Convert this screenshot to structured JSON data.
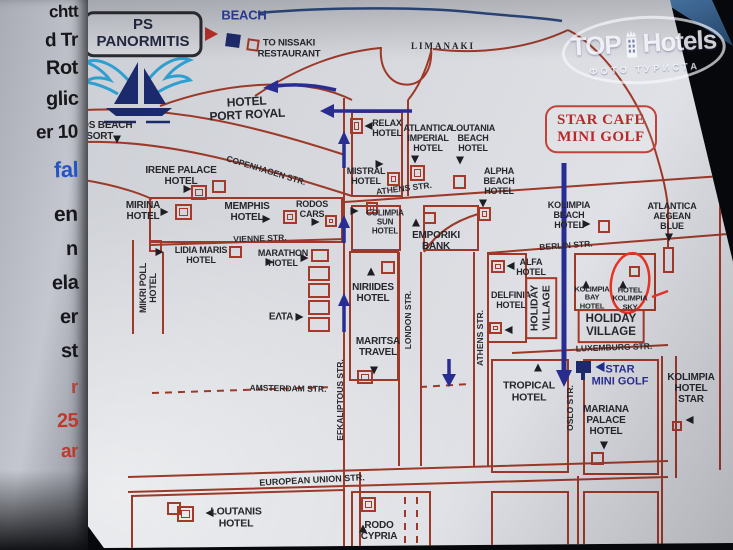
{
  "watermark": {
    "t1": "TOP",
    "t2": "Hotels",
    "sub": "ФОТО ТУРИСТА"
  },
  "neighbor_page": {
    "fragments": [
      {
        "t": "chtt",
        "y": 2,
        "c": "#17171b",
        "s": 17
      },
      {
        "t": "d Tr",
        "y": 30,
        "c": "#17171b",
        "s": 19
      },
      {
        "t": "Rot",
        "y": 57,
        "c": "#17171b",
        "s": 20
      },
      {
        "t": "glic",
        "y": 88,
        "c": "#17171b",
        "s": 20
      },
      {
        "t": "er 10",
        "y": 122,
        "c": "#17171b",
        "s": 19
      },
      {
        "t": "fal",
        "y": 157,
        "c": "#2356c4",
        "s": 22
      },
      {
        "t": "en",
        "y": 203,
        "c": "#17171b",
        "s": 21
      },
      {
        "t": "n",
        "y": 238,
        "c": "#17171b",
        "s": 20
      },
      {
        "t": "ela",
        "y": 272,
        "c": "#17171b",
        "s": 20
      },
      {
        "t": "er",
        "y": 306,
        "c": "#17171b",
        "s": 20
      },
      {
        "t": "st",
        "y": 340,
        "c": "#17171b",
        "s": 20
      },
      {
        "t": "r",
        "y": 377,
        "c": "#b4443c",
        "s": 19
      },
      {
        "t": "25",
        "y": 410,
        "c": "#c0392d",
        "s": 20
      },
      {
        "t": "ar",
        "y": 441,
        "c": "#c0392d",
        "s": 19
      }
    ]
  },
  "map": {
    "labels": [
      {
        "id": "sign-ps-panormitis",
        "t": "PS\nPANORMITIS",
        "x": 143,
        "y": 34,
        "cls": "sign-ps",
        "fs": 15
      },
      {
        "id": "label-beach",
        "t": "BEACH",
        "x": 244,
        "y": 16,
        "cls": "blue",
        "fs": 13
      },
      {
        "id": "label-to-nissaki",
        "t": "TO NISSAKI\nRESTAURANT",
        "x": 289,
        "y": 49,
        "fs": 9.5
      },
      {
        "id": "label-limanaki",
        "t": "LIMANAKI",
        "x": 443,
        "y": 46,
        "cls": "serif",
        "fs": 9
      },
      {
        "id": "sign-star-cafe",
        "t": "STAR CAFE\nMINI GOLF",
        "x": 601,
        "y": 129,
        "cls": "sign-cafe",
        "fs": 15
      },
      {
        "id": "hotel-port-royal",
        "t": "HOTEL\nPORT ROYAL",
        "x": 247,
        "y": 109,
        "r": -3,
        "fs": 12
      },
      {
        "id": "hotel-mythos-beach",
        "t": "MYTHOS BEACH\nRESORT",
        "x": 93,
        "y": 131,
        "fs": 10
      },
      {
        "id": "hotel-irene-palace",
        "t": "IRENE PALACE\nHOTEL",
        "x": 181,
        "y": 176,
        "fs": 10
      },
      {
        "id": "hotel-mirina",
        "t": "MIRINA\nHOTEL",
        "x": 143,
        "y": 211,
        "fs": 10
      },
      {
        "id": "hotel-memphis",
        "t": "MEMPHIS\nHOTEL",
        "x": 247,
        "y": 212,
        "fs": 10
      },
      {
        "id": "label-rodos-cars",
        "t": "RODOS\nCARS",
        "x": 312,
        "y": 209
      },
      {
        "id": "hotel-lidia-maris",
        "t": "LIDIA MARIS\nHOTEL",
        "x": 201,
        "y": 255
      },
      {
        "id": "hotel-marathon",
        "t": "MARATHON\nHOTEL",
        "x": 283,
        "y": 258
      },
      {
        "id": "hotel-mikri-poll",
        "t": "MIKRI POLL\nHOTEL",
        "x": 148,
        "y": 288,
        "r": -90
      },
      {
        "id": "label-elta",
        "t": "ΕΛΤΑ",
        "x": 281,
        "y": 317,
        "fs": 10
      },
      {
        "id": "hotel-niriides",
        "t": "NIRIIDES\nHOTEL",
        "x": 373,
        "y": 293,
        "fs": 10
      },
      {
        "id": "label-maritsa-travel",
        "t": "MARITSA\nTRAVEL",
        "x": 378,
        "y": 347,
        "fs": 10
      },
      {
        "id": "label-emporiki-bank",
        "t": "EMPORIKI\nBANK",
        "x": 436,
        "y": 241,
        "fs": 10
      },
      {
        "id": "hotel-colimpia-sun",
        "t": "COLIMPIA\nSUN\nHOTEL",
        "x": 385,
        "y": 223,
        "fs": 8
      },
      {
        "id": "hotel-relax",
        "t": "RELAX\nHOTEL",
        "x": 387,
        "y": 128
      },
      {
        "id": "hotel-mistral",
        "t": "MISTRAL\nHOTEL",
        "x": 366,
        "y": 176
      },
      {
        "id": "hotel-atlantica-imperial",
        "t": "ATLANTICA\nIMPERIAL\nHOTEL",
        "x": 428,
        "y": 138
      },
      {
        "id": "hotel-loutania-beach",
        "t": "LOUTANIA\nBEACH\nHOTEL",
        "x": 473,
        "y": 138
      },
      {
        "id": "hotel-alpha-beach",
        "t": "ALPHA\nBEACH\nHOTEL",
        "x": 499,
        "y": 181
      },
      {
        "id": "hotel-kolimpia-beach",
        "t": "KOLIMPIA\nBEACH\nHOTEL",
        "x": 569,
        "y": 215
      },
      {
        "id": "hotel-atlantica-aegean",
        "t": "ATLANTICA\nAEGEAN\nBLUE",
        "x": 672,
        "y": 216
      },
      {
        "id": "hotel-alfa",
        "t": "ALFA\nHOTEL",
        "x": 531,
        "y": 267
      },
      {
        "id": "hotel-delfinia",
        "t": "DELFINIA\nHOTEL",
        "x": 511,
        "y": 300
      },
      {
        "id": "hotel-kolimpia-bay",
        "t": "KOLIMPIA\nBAY\nHOTEL",
        "x": 592,
        "y": 298,
        "fs": 7.5
      },
      {
        "id": "hotel-kolimpia-sky",
        "t": "HOTEL\nKOLIMPIA\nSKY",
        "x": 630,
        "y": 299,
        "fs": 7.5
      },
      {
        "id": "box-holiday-village-vertical",
        "t": "HOLIDAY\nVILLAGE",
        "x": 541,
        "y": 308,
        "r": -90,
        "cls": "boxed",
        "fs": 10.5
      },
      {
        "id": "box-holiday-village",
        "t": "HOLIDAY\nVILLAGE",
        "x": 611,
        "y": 326,
        "cls": "boxed",
        "fs": 11.5
      },
      {
        "id": "label-star-mini-golf",
        "t": "STAR\nMINI GOLF",
        "x": 620,
        "y": 376,
        "cls": "bluebold",
        "fs": 11
      },
      {
        "id": "hotel-tropical",
        "t": "TROPICAL\nHOTEL",
        "x": 529,
        "y": 392,
        "fs": 10.5
      },
      {
        "id": "hotel-mariana-palace",
        "t": "MARIANA\nPALACE\nHOTEL",
        "x": 606,
        "y": 421,
        "fs": 10
      },
      {
        "id": "hotel-kolimpia-star",
        "t": "KOLIMPIA\nHOTEL\nSTAR",
        "x": 691,
        "y": 389,
        "fs": 10
      },
      {
        "id": "hotel-loutanis",
        "t": "LOUTANIS\nHOTEL",
        "x": 236,
        "y": 518,
        "fs": 10.5
      },
      {
        "id": "hotel-rodo-cypria",
        "t": "RODO\nCYPRIA",
        "x": 379,
        "y": 531,
        "fs": 10
      },
      {
        "id": "street-vienne",
        "t": "VIENNE STR.",
        "x": 260,
        "y": 239,
        "r": -2,
        "cls": "street"
      },
      {
        "id": "street-copenhagen",
        "t": "COPENHAGEN STR.",
        "x": 266,
        "y": 171,
        "r": 17,
        "cls": "street"
      },
      {
        "id": "street-athens-upper",
        "t": "ATHENS STR.",
        "x": 404,
        "y": 189,
        "r": -7,
        "cls": "street"
      },
      {
        "id": "street-berlin",
        "t": "BERLIN STR.",
        "x": 566,
        "y": 246,
        "r": -4,
        "cls": "street"
      },
      {
        "id": "street-luxemburg",
        "t": "LUXEMBURG STR.",
        "x": 614,
        "y": 348,
        "r": -2,
        "cls": "street"
      },
      {
        "id": "street-amsterdam",
        "t": "AMSTERDAM STR.",
        "x": 288,
        "y": 389,
        "r": 1,
        "cls": "street"
      },
      {
        "id": "street-european-union",
        "t": "EUROPEAN UNION STR.",
        "x": 312,
        "y": 480,
        "r": -3,
        "cls": "street",
        "fs": 9
      },
      {
        "id": "street-athens-vertical",
        "t": "ATHENS STR.",
        "x": 481,
        "y": 338,
        "r": -90,
        "cls": "street"
      },
      {
        "id": "street-london",
        "t": "LONDON STR.",
        "x": 409,
        "y": 320,
        "r": -90,
        "cls": "street"
      },
      {
        "id": "street-efkaliptous",
        "t": "EFKALIPTOUS STR.",
        "x": 341,
        "y": 400,
        "r": -90,
        "cls": "street"
      },
      {
        "id": "street-oslo",
        "t": "OSLO STR.",
        "x": 571,
        "y": 408,
        "r": -90,
        "cls": "street"
      }
    ],
    "markers": [
      {
        "id": "ps-arrow",
        "x": 216,
        "y": 34,
        "dir": "r",
        "c": "#bf2e27",
        "s": 9
      },
      {
        "id": "mythos-marker",
        "x": 117,
        "y": 142,
        "dir": "d"
      },
      {
        "id": "irene-marker",
        "x": 190,
        "y": 189,
        "dir": "r"
      },
      {
        "id": "mirina-marker",
        "x": 167,
        "y": 212,
        "dir": "r"
      },
      {
        "id": "memphis-marker",
        "x": 269,
        "y": 219,
        "dir": "r"
      },
      {
        "id": "rodos-cars-marker",
        "x": 318,
        "y": 222,
        "dir": "r"
      },
      {
        "id": "lidia-marker",
        "x": 272,
        "y": 262,
        "dir": "r"
      },
      {
        "id": "marathon-marker",
        "x": 307,
        "y": 258,
        "dir": "r"
      },
      {
        "id": "mikri-marker",
        "x": 162,
        "y": 252,
        "dir": "r"
      },
      {
        "id": "elta-marker",
        "x": 302,
        "y": 317,
        "dir": "r"
      },
      {
        "id": "niriides-marker",
        "x": 371,
        "y": 269,
        "dir": "u"
      },
      {
        "id": "maritsa-marker",
        "x": 374,
        "y": 373,
        "dir": "d"
      },
      {
        "id": "emporiki-marker",
        "x": 416,
        "y": 220,
        "dir": "u"
      },
      {
        "id": "colimpia-sun-marker",
        "x": 357,
        "y": 211,
        "dir": "r"
      },
      {
        "id": "relax-marker",
        "x": 366,
        "y": 126,
        "dir": "l"
      },
      {
        "id": "mistral-marker",
        "x": 382,
        "y": 164,
        "dir": "r"
      },
      {
        "id": "atlantica-imperial-marker",
        "x": 415,
        "y": 162,
        "dir": "d"
      },
      {
        "id": "loutania-marker",
        "x": 460,
        "y": 163,
        "dir": "d"
      },
      {
        "id": "alpha-marker",
        "x": 483,
        "y": 206,
        "dir": "d"
      },
      {
        "id": "alfa-marker",
        "x": 508,
        "y": 266,
        "dir": "l"
      },
      {
        "id": "delfinia-marker",
        "x": 506,
        "y": 330,
        "dir": "l"
      },
      {
        "id": "kolimpia-beach-marker",
        "x": 589,
        "y": 224,
        "dir": "r"
      },
      {
        "id": "aegean-marker",
        "x": 669,
        "y": 240,
        "dir": "d"
      },
      {
        "id": "kolimpia-bay-marker",
        "x": 586,
        "y": 282,
        "dir": "u"
      },
      {
        "id": "kolimpia-sky-marker",
        "x": 623,
        "y": 282,
        "dir": "u"
      },
      {
        "id": "tropical-marker",
        "x": 538,
        "y": 365,
        "dir": "u"
      },
      {
        "id": "mariana-marker",
        "x": 604,
        "y": 448,
        "dir": "d"
      },
      {
        "id": "kolimpia-star-marker",
        "x": 687,
        "y": 420,
        "dir": "l"
      },
      {
        "id": "loutanis-marker",
        "x": 207,
        "y": 513,
        "dir": "l"
      },
      {
        "id": "rodo-marker",
        "x": 363,
        "y": 526,
        "dir": "u"
      },
      {
        "id": "star-golf-marker",
        "x": 597,
        "y": 367,
        "dir": "l",
        "c": "#232d8f",
        "s": 6
      }
    ],
    "boxes": [
      {
        "id": "mythos-box",
        "x": 61,
        "y": 149,
        "w": 20,
        "h": 17
      },
      {
        "id": "irene-box-a",
        "x": 191,
        "y": 185,
        "w": 16,
        "h": 15,
        "inner": 1
      },
      {
        "id": "irene-box-b",
        "x": 212,
        "y": 180,
        "w": 14,
        "h": 13
      },
      {
        "id": "mirina-box",
        "x": 175,
        "y": 204,
        "w": 17,
        "h": 16,
        "inner": 1
      },
      {
        "id": "vienne-box",
        "x": 149,
        "y": 240,
        "w": 13,
        "h": 12
      },
      {
        "id": "memphis-box",
        "x": 283,
        "y": 210,
        "w": 14,
        "h": 14,
        "inner": 1
      },
      {
        "id": "rodos-box",
        "x": 325,
        "y": 215,
        "w": 12,
        "h": 12,
        "inner": 1
      },
      {
        "id": "lidia-box",
        "x": 229,
        "y": 246,
        "w": 13,
        "h": 12
      },
      {
        "id": "marathon-box",
        "x": 311,
        "y": 249,
        "w": 18,
        "h": 13
      },
      {
        "id": "shops-box-1",
        "x": 308,
        "y": 266,
        "w": 22,
        "h": 15
      },
      {
        "id": "shops-box-2",
        "x": 308,
        "y": 283,
        "w": 22,
        "h": 15
      },
      {
        "id": "shops-box-3",
        "x": 308,
        "y": 300,
        "w": 22,
        "h": 15
      },
      {
        "id": "shops-box-4",
        "x": 308,
        "y": 317,
        "w": 22,
        "h": 15
      },
      {
        "id": "relax-box",
        "x": 350,
        "y": 118,
        "w": 13,
        "h": 16,
        "inner": 1
      },
      {
        "id": "mistral-box",
        "x": 387,
        "y": 172,
        "w": 13,
        "h": 14,
        "inner": 1
      },
      {
        "id": "atlantica-imperial-box",
        "x": 410,
        "y": 165,
        "w": 15,
        "h": 16,
        "inner": 1
      },
      {
        "id": "loutania-box",
        "x": 453,
        "y": 175,
        "w": 13,
        "h": 14
      },
      {
        "id": "alpha-box",
        "x": 478,
        "y": 207,
        "w": 13,
        "h": 14,
        "inner": 1
      },
      {
        "id": "colimpia-sun-box",
        "x": 366,
        "y": 202,
        "w": 12,
        "h": 12,
        "inner": 1
      },
      {
        "id": "emporiki-box",
        "x": 423,
        "y": 212,
        "w": 13,
        "h": 12
      },
      {
        "id": "niriides-box",
        "x": 381,
        "y": 261,
        "w": 14,
        "h": 13
      },
      {
        "id": "maritsa-box",
        "x": 357,
        "y": 370,
        "w": 16,
        "h": 14,
        "inner": 1
      },
      {
        "id": "alfa-box",
        "x": 491,
        "y": 260,
        "w": 14,
        "h": 13,
        "inner": 1
      },
      {
        "id": "delfinia-box",
        "x": 489,
        "y": 322,
        "w": 13,
        "h": 12,
        "inner": 1
      },
      {
        "id": "kolimpia-beach-box",
        "x": 598,
        "y": 220,
        "w": 12,
        "h": 13
      },
      {
        "id": "kolimpia-sky-box",
        "x": 629,
        "y": 266,
        "w": 11,
        "h": 11
      },
      {
        "id": "aegean-building-box",
        "x": 663,
        "y": 247,
        "w": 11,
        "h": 26
      },
      {
        "id": "mariana-box",
        "x": 591,
        "y": 452,
        "w": 13,
        "h": 13
      },
      {
        "id": "kolimpia-star-box",
        "x": 672,
        "y": 421,
        "w": 10,
        "h": 10
      },
      {
        "id": "loutanis-box",
        "x": 177,
        "y": 506,
        "w": 17,
        "h": 16,
        "inner": 1
      },
      {
        "id": "rodo-box",
        "x": 361,
        "y": 497,
        "w": 15,
        "h": 15,
        "inner": 1
      },
      {
        "id": "corner-box",
        "x": 167,
        "y": 502,
        "w": 14,
        "h": 13
      },
      {
        "id": "nissaki-red-box",
        "x": 247,
        "y": 39,
        "w": 12,
        "h": 12,
        "rot": 8
      },
      {
        "id": "nissaki-navy-box",
        "x": 226,
        "y": 34,
        "w": 14,
        "h": 13,
        "rot": 8,
        "fill": 1
      },
      {
        "id": "star-golf-flag",
        "x": 576,
        "y": 361,
        "w": 15,
        "h": 12,
        "fill": 1
      },
      {
        "id": "star-golf-pole",
        "x": 581,
        "y": 372,
        "w": 4,
        "h": 8,
        "fill": 1
      }
    ]
  }
}
